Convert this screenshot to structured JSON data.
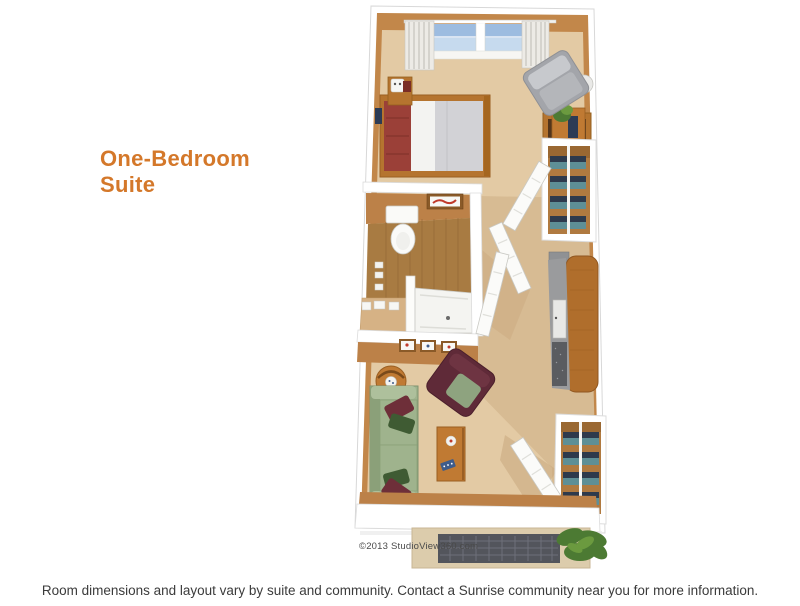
{
  "title": {
    "line1": "One-Bedroom",
    "line2": "Suite",
    "color": "#D4782A"
  },
  "floorplan": {
    "credit": "©2013 StudioView360.com",
    "colors": {
      "outer_wall": "#FFFFFF",
      "outer_wall_edge": "#D8D8D8",
      "wall_face": "#C2874A",
      "wall_face_dark": "#BC8148",
      "floor": "#E3CAA4",
      "floor_hall": "#D7BB93",
      "floor_shadow": "#C9A87E",
      "wood_floor": "#A87B42",
      "window_glass": "#9DBCE0",
      "window_glass_light": "#C6DAEE",
      "curtain": "#EDEBE6",
      "wood_furniture": "#B5742F",
      "wood_table": "#C07A33",
      "bed_blanket": "#9B4038",
      "bed_sheet": "#F3F3F1",
      "bed_duvet": "#D2D2D6",
      "sofa_green": "#9FB38D",
      "pillow_red": "#6E2F39",
      "pillow_green": "#3F5B33",
      "armchair_maroon": "#5F2A38",
      "armchair_cushion": "#8EA37F",
      "armchair_gray": "#A3A5AA",
      "counter_gray": "#9A9B9D",
      "appliance_dark": "#5A5C60",
      "closet_interior": "#B07A40",
      "shelf_teal": "#5E8F96",
      "shelf_navy": "#2E3A4C",
      "fixture_white": "#FAFAF8",
      "door_white": "#FBFBF9",
      "mat_border": "#DCCCAC",
      "mat_dark": "#53555C",
      "plant_green": "#4C7A33",
      "plant_green_light": "#6B9A3F",
      "credit_color": "#4A4A4A"
    }
  },
  "footer": {
    "caption": "Room dimensions and layout vary by suite and community. Contact a Sunrise community near you for more information.",
    "color": "#3B3B3B"
  }
}
